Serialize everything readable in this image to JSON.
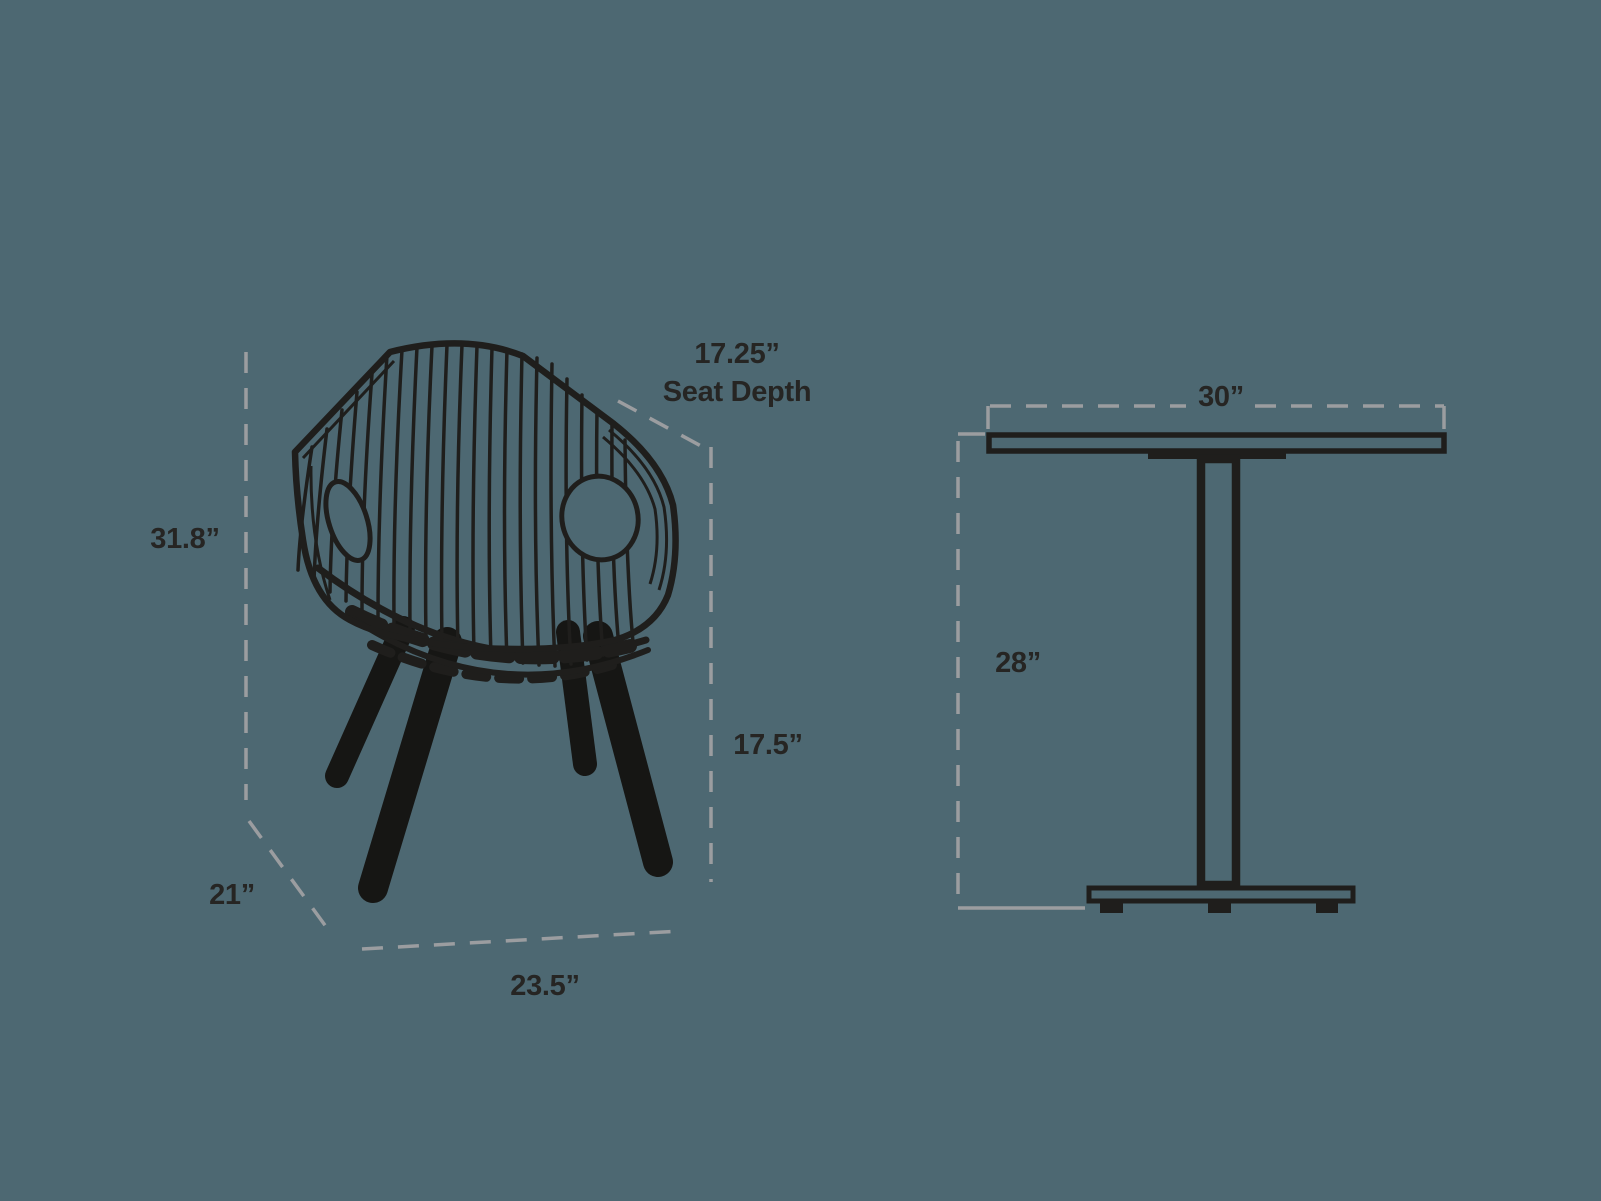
{
  "canvas": {
    "background_color": "#4D6872",
    "line_art_color": "#1F1E1C",
    "guide_line_color": "#9B9DA0",
    "label_color": "#262523"
  },
  "chair": {
    "illustration": "wireframe-armchair-with-wood-legs",
    "dimensions": {
      "seat_depth_value": "17.25”",
      "seat_depth_caption": "Seat Depth",
      "overall_height": "31.8”",
      "seat_height": "17.5”",
      "overall_depth": "21”",
      "overall_width": "23.5”"
    }
  },
  "table": {
    "illustration": "pedestal-cafe-table-side-view",
    "dimensions": {
      "width": "30”",
      "height": "28”"
    }
  }
}
